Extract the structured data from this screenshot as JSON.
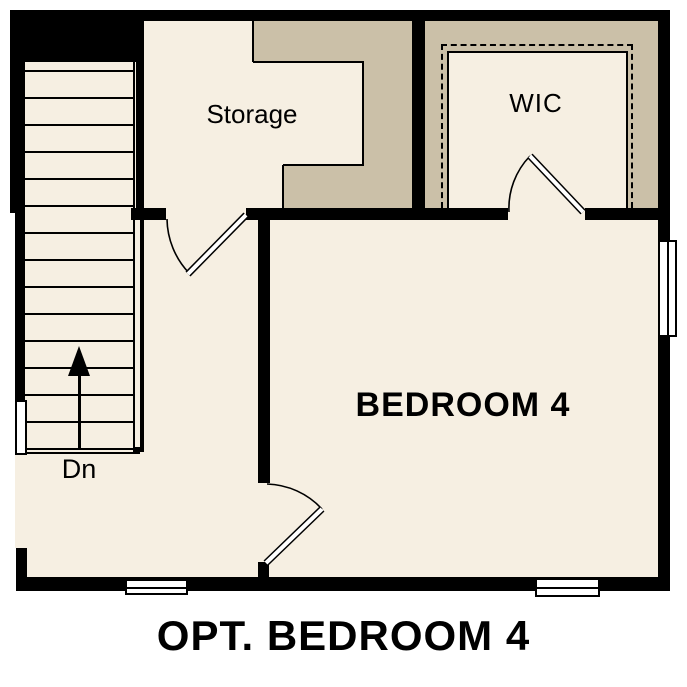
{
  "title": "OPT. BEDROOM 4",
  "rooms": {
    "storage": {
      "label": "Storage"
    },
    "wic": {
      "label": "WIC"
    },
    "bedroom": {
      "label": "BEDROOM 4"
    }
  },
  "stairs": {
    "direction_label": "Dn",
    "tread_count": 15
  },
  "colors": {
    "wall": "#000000",
    "floor": "#f6efe2",
    "attic": "#cbc0a8",
    "background": "#ffffff",
    "text": "#000000"
  }
}
